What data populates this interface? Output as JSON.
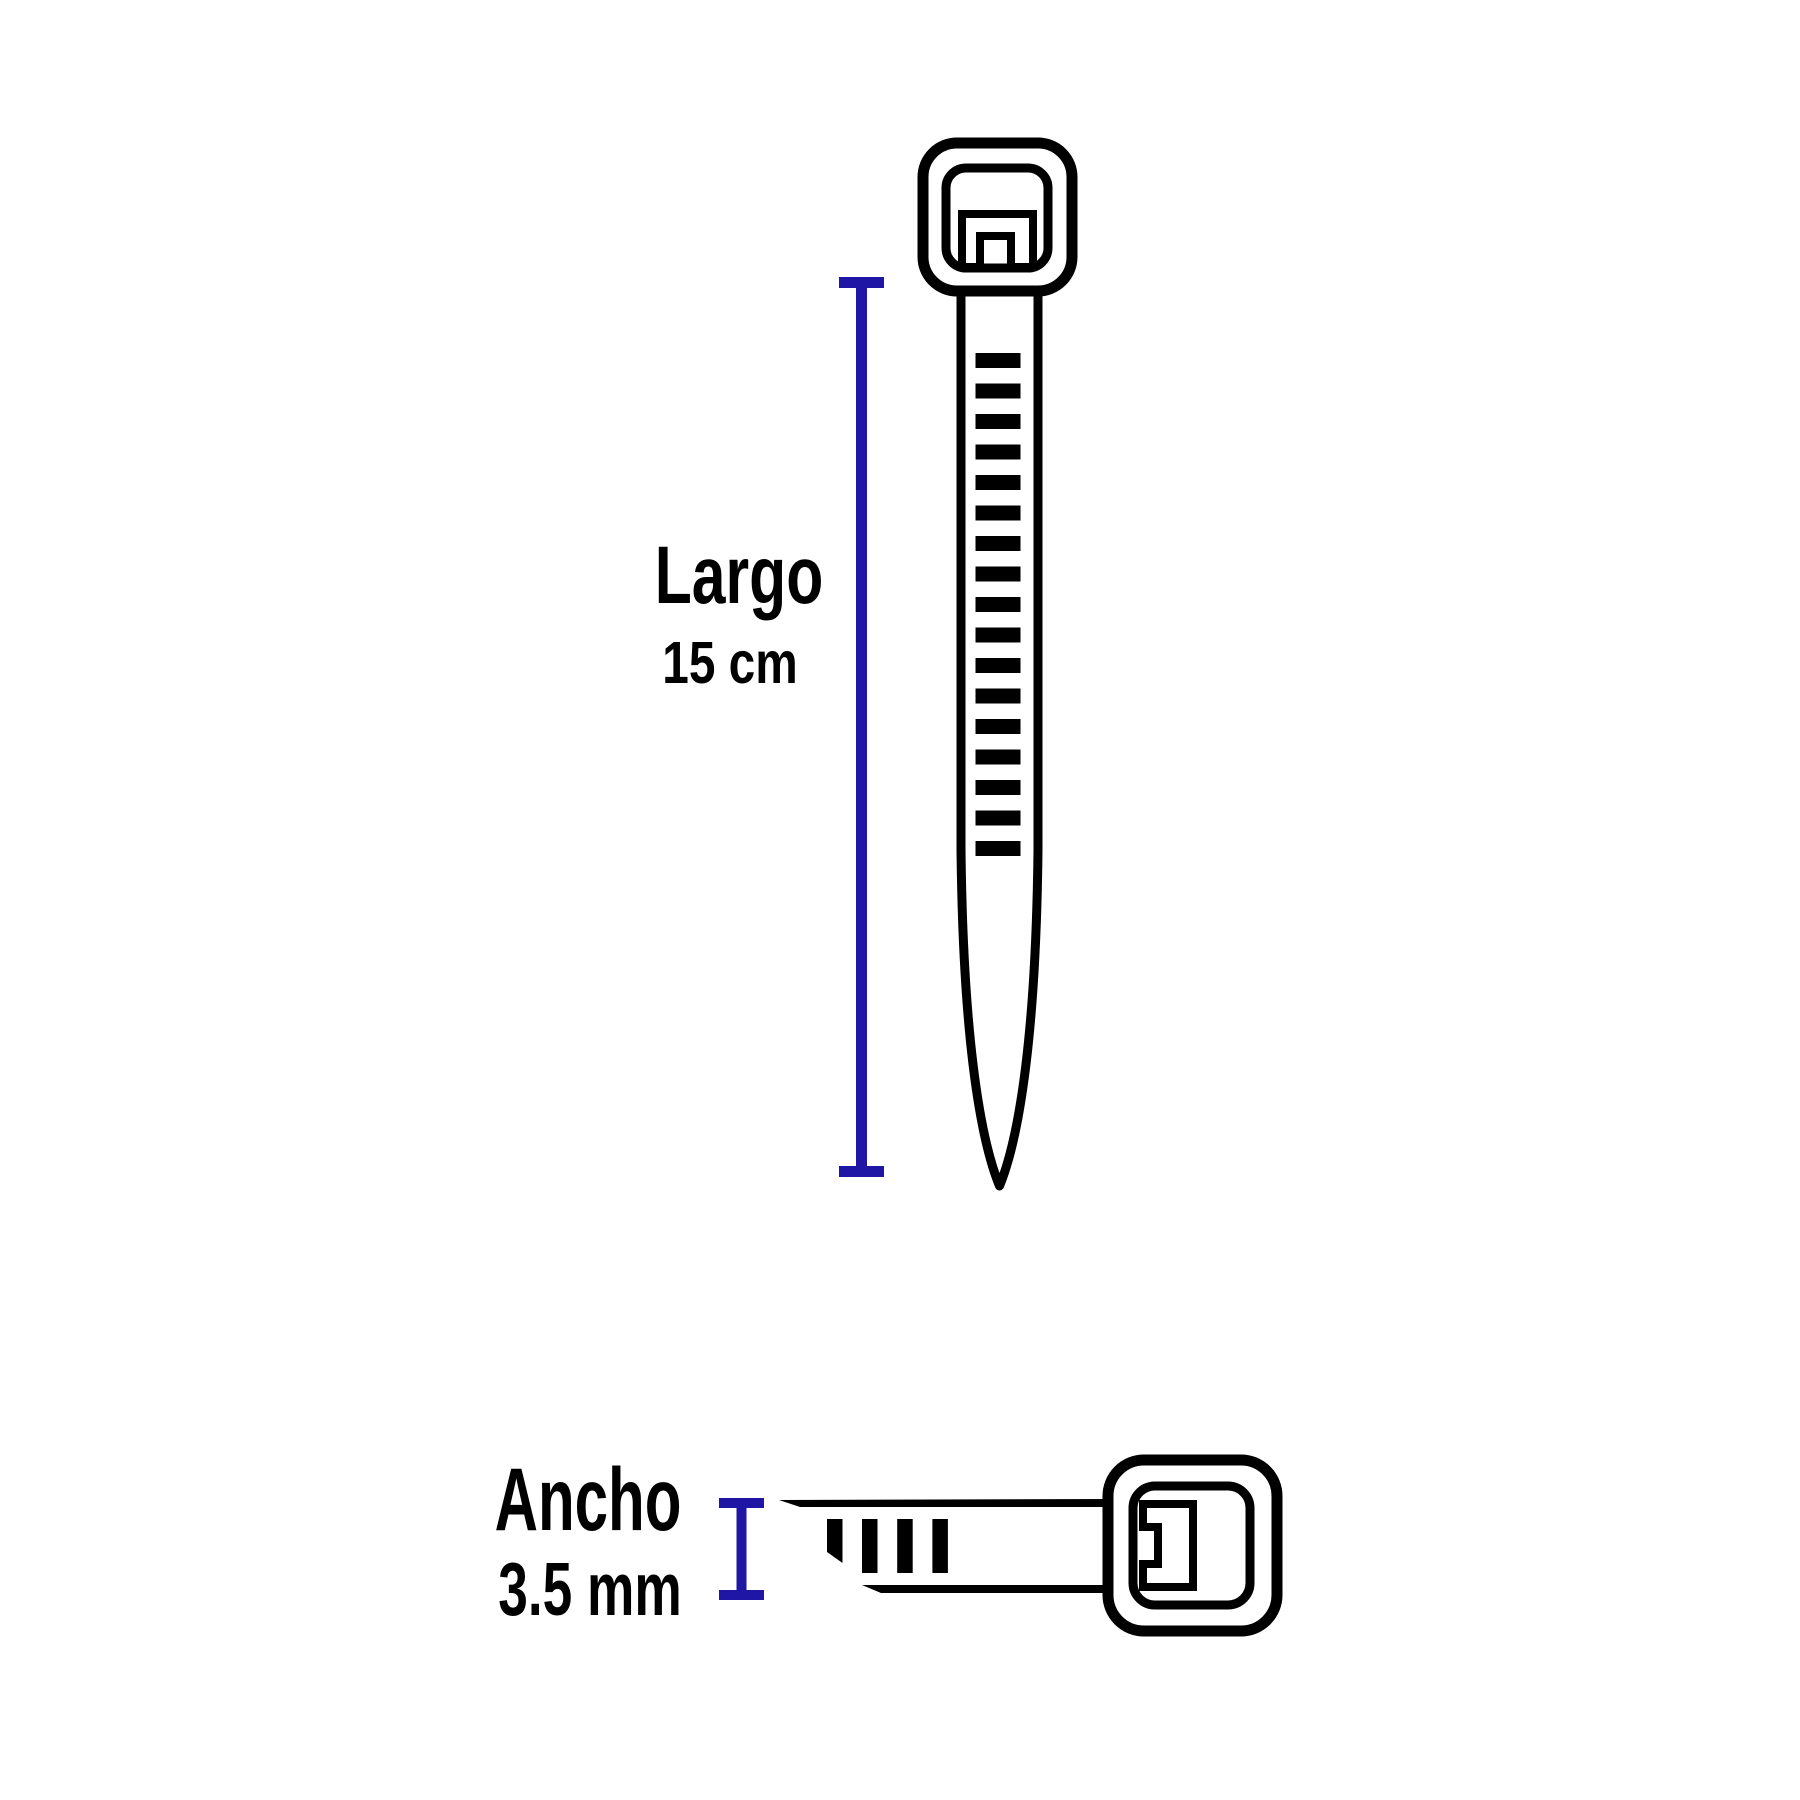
{
  "figure": {
    "background": "#ffffff"
  },
  "colors": {
    "outline": "#000000",
    "dimension": "#2016A6",
    "text": "#000000"
  },
  "labels": {
    "length_label": "Largo",
    "length_value": "15 cm",
    "width_label": "Ancho",
    "width_value": "3.5 mm"
  },
  "vertical_tie": {
    "teeth_count": 17
  },
  "horizontal_tie": {
    "teeth_count": 4
  }
}
